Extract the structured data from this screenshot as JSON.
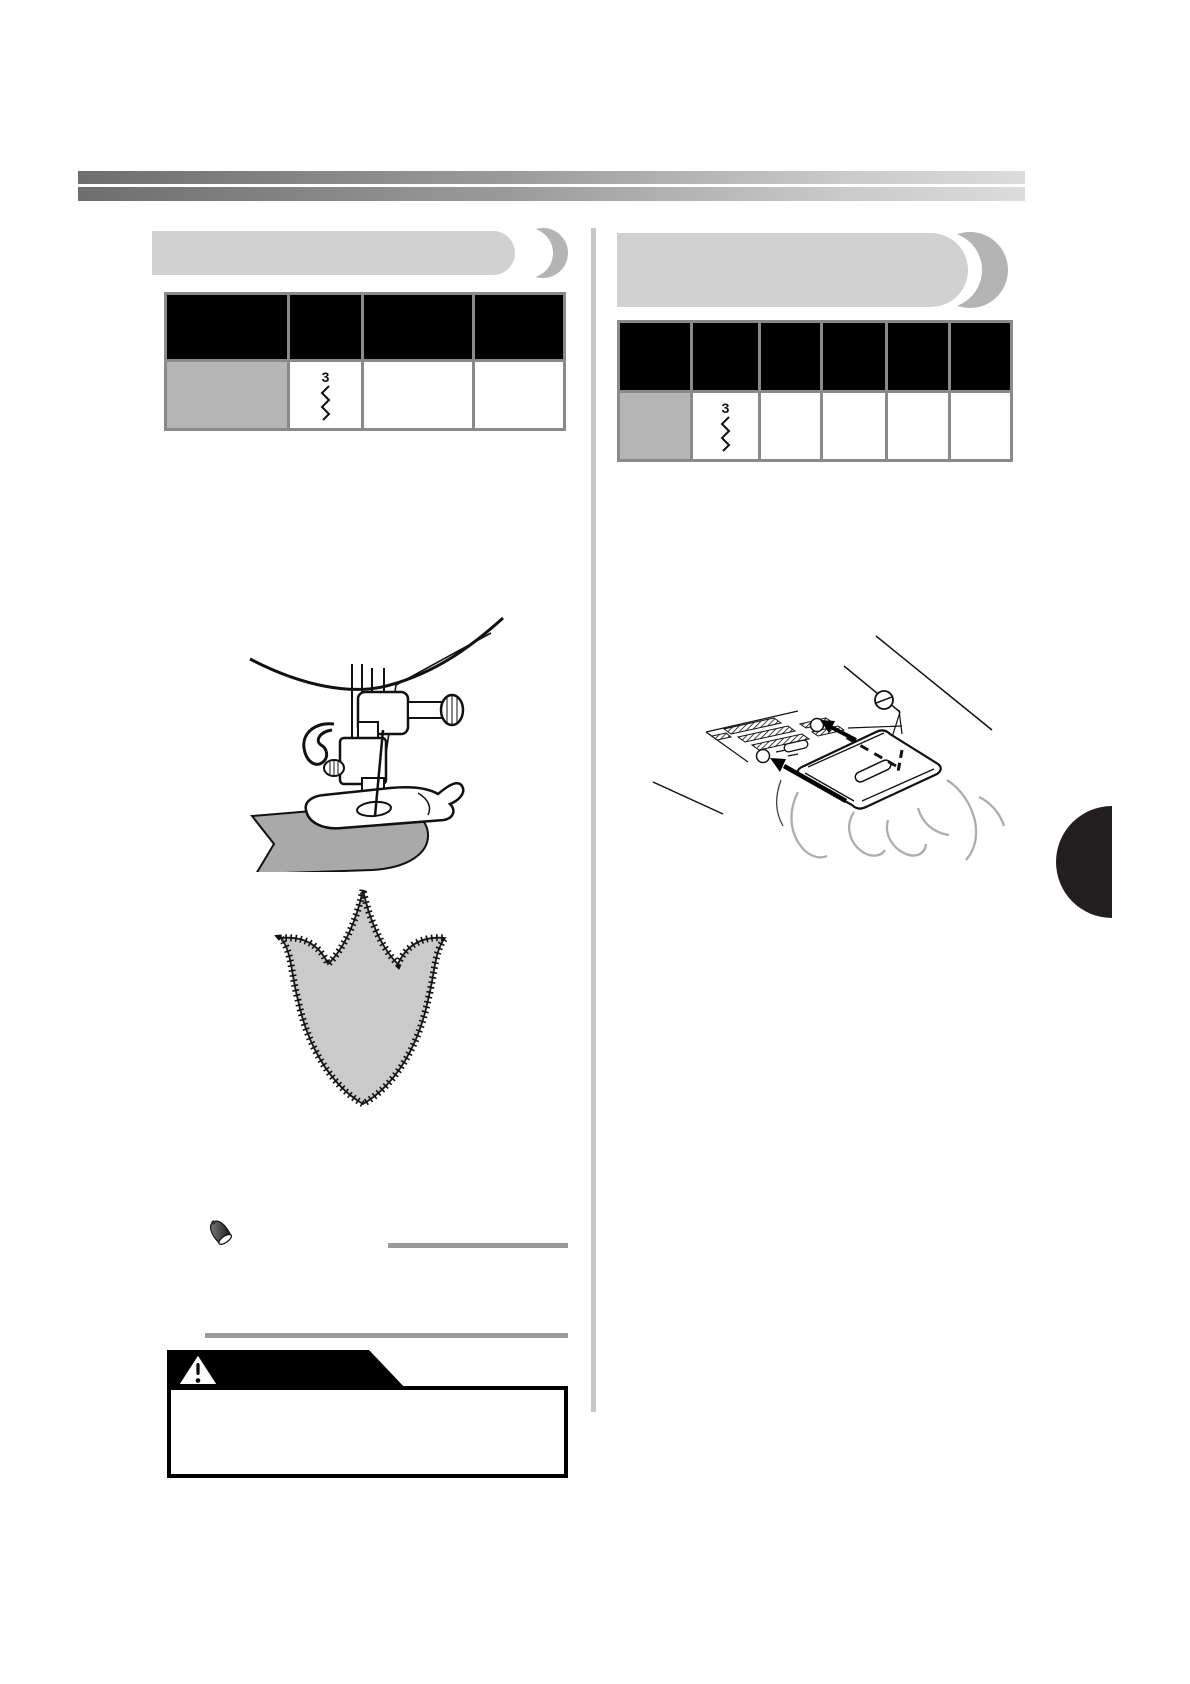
{
  "page": {
    "kind": "sewing-machine-manual-page",
    "colors": {
      "banner_pill": "#d1d1d1",
      "banner_crescent": "#b4b4b4",
      "table_border": "#8a8a8a",
      "table_header_bg": "#000000",
      "table_swatch_cell": "#b5b5b5",
      "column_divider": "#c7c7c7",
      "gray_rule": "#9a9a9a",
      "gradient_start": "#6e6e6e",
      "gradient_end": "#dcdcdc",
      "side_tab": "#221e1f",
      "applique_fill": "#a9a9a9",
      "tulip_fill": "#cacaca"
    }
  },
  "left_section": {
    "banner_label": "",
    "table": {
      "header_cells": [
        "",
        "",
        "",
        ""
      ],
      "row": [
        {
          "kind": "swatch",
          "label": ""
        },
        {
          "kind": "stitch",
          "stitch_width": "3",
          "icon": "zigzag-stitch-icon"
        },
        {
          "kind": "blank",
          "label": ""
        },
        {
          "kind": "blank",
          "label": ""
        }
      ]
    },
    "illustrations": [
      {
        "name": "presser-foot-sewing-applique"
      },
      {
        "name": "tulip-applique-zigzag-stitched"
      }
    ],
    "note_icon": "thimble-note-icon",
    "caution": {
      "banner_label": "",
      "icon": "warning-triangle-icon",
      "text": ""
    }
  },
  "right_section": {
    "banner_label": "",
    "table": {
      "header_cells": [
        "",
        "",
        "",
        "",
        "",
        ""
      ],
      "row": [
        {
          "kind": "swatch",
          "label": ""
        },
        {
          "kind": "stitch",
          "stitch_width": "3",
          "icon": "zigzag-stitch-icon"
        },
        {
          "kind": "blank",
          "label": ""
        },
        {
          "kind": "blank",
          "label": ""
        },
        {
          "kind": "blank",
          "label": ""
        },
        {
          "kind": "blank",
          "label": ""
        }
      ]
    },
    "illustrations": [
      {
        "name": "needle-plate-cover-slide"
      }
    ]
  },
  "side_tab": {
    "shape": "half-circle",
    "color": "#221e1f"
  }
}
